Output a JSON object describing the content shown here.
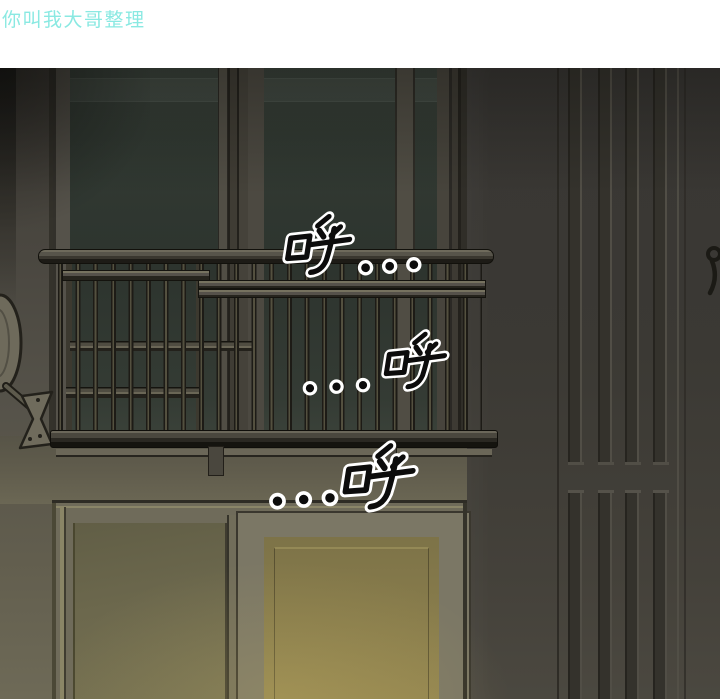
{
  "header": {
    "credit_text": "你叫我大哥整理"
  },
  "panel": {
    "sfx": [
      {
        "text": "呼..."
      },
      {
        "text": "...呼"
      },
      {
        "text": "...呼"
      }
    ],
    "colors": {
      "header_text": "#8ae9e2",
      "left_wall": "#55524a",
      "door_wall": "#3b3934",
      "upper_window_glass": "#2f3630",
      "lit_window_glass": "#8d8150",
      "railing_metal": "#4e4b41",
      "sfx_fill": "#0c0c0c",
      "sfx_outline": "#ffffff"
    }
  }
}
